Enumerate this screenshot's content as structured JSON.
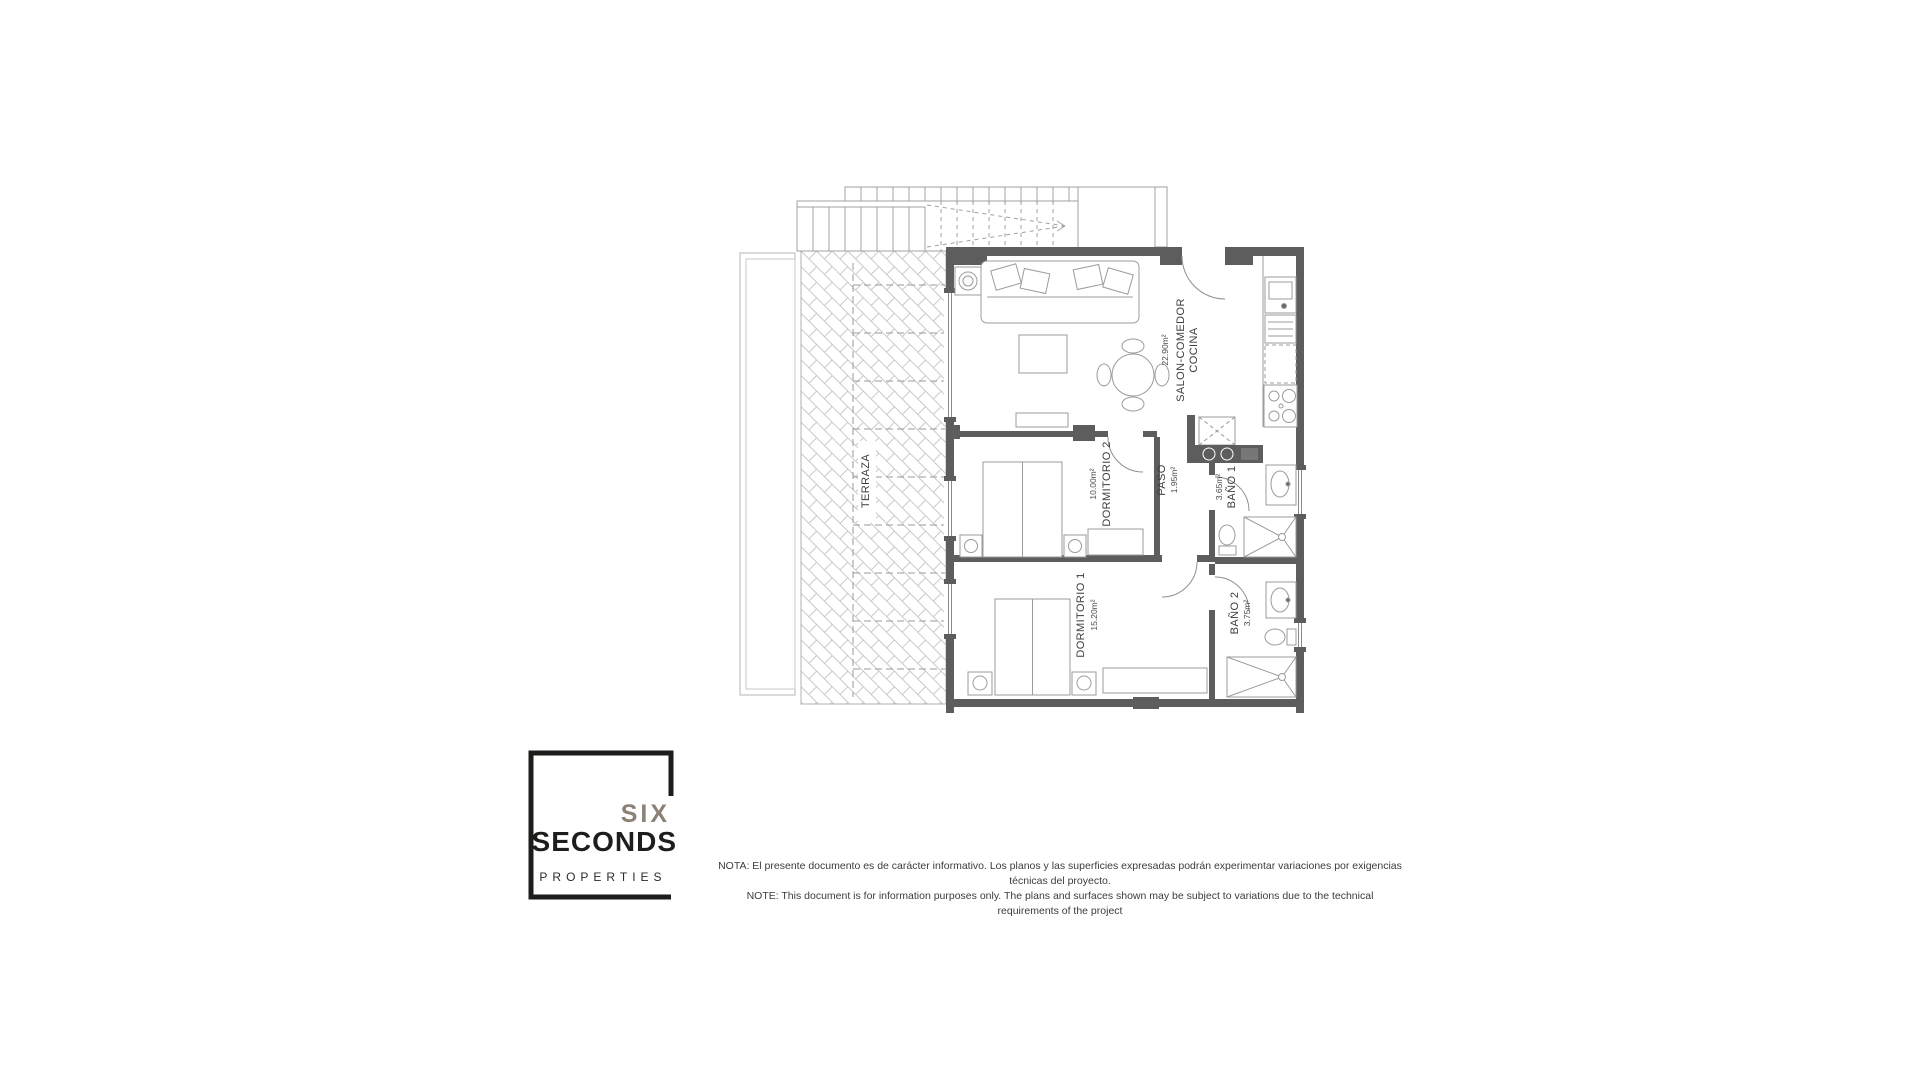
{
  "floorplan": {
    "rooms": {
      "salon": {
        "name": "SALON-COMEDOR",
        "name2": "COCINA",
        "area": "22.90m²"
      },
      "dormitorio2": {
        "name": "DORMITORIO 2",
        "area": "10.00m²"
      },
      "paso": {
        "name": "PASO",
        "area": "1.95m²"
      },
      "bano1": {
        "name": "BAÑO 1",
        "area": "3.65m²"
      },
      "dormitorio1": {
        "name": "DORMITORIO 1",
        "area": "15.20m²"
      },
      "bano2": {
        "name": "BAÑO 2",
        "area": "3.75m²"
      },
      "terraza": {
        "name": "TERRAZA"
      }
    },
    "colors": {
      "wall": "#5d5d5d",
      "line": "#9b9b9b",
      "hatch": "#c9c9c9"
    }
  },
  "logo": {
    "line1": "SIX",
    "line2": "SECONDS",
    "line3": "PROPERTIES",
    "six_color": "#8c8177",
    "text_color": "#1d1d1b"
  },
  "disclaimer": {
    "line1": "NOTA: El presente documento es de carácter informativo. Los planos y las superficies expresadas podrán experimentar variaciones por exigencias técnicas del proyecto.",
    "line2": "NOTE: This document is for information purposes only. The plans and surfaces shown may be subject to variations due to the technical requirements of the project"
  }
}
